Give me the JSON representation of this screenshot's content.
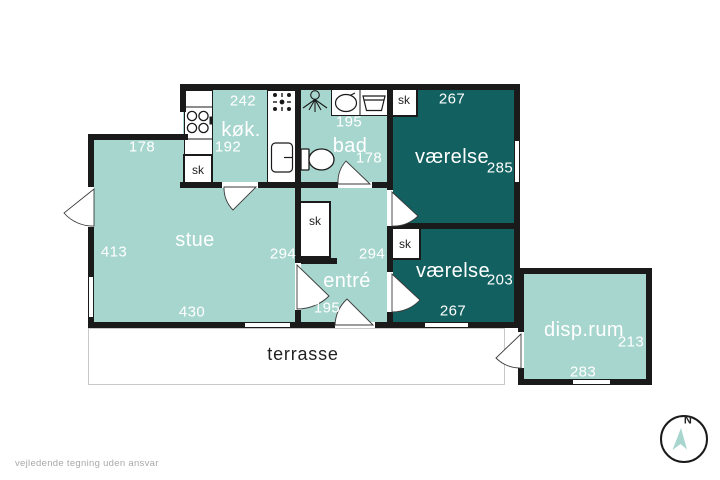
{
  "meta": {
    "disclaimer": "vejledende tegning uden ansvar",
    "compass_north": "N"
  },
  "colors": {
    "room_light": "#a7d6ce",
    "room_dark": "#136060",
    "wall": "#1a1a1a",
    "terrace_border": "#c9c9c9",
    "text_light": "#ffffff",
    "text_dark": "#222222",
    "muted": "#a8a8a8",
    "compass_arrow": "#a8d5ce"
  },
  "plan": {
    "closet_label": "sk",
    "rooms": {
      "stue": {
        "name": "stue",
        "m_top": "178",
        "m_left": "413",
        "m_right": "294",
        "m_bottom": "430"
      },
      "koekken": {
        "name": "køk.",
        "m_top": "242",
        "m_bottom": "192"
      },
      "bad": {
        "name": "bad",
        "m_top": "195",
        "m_right": "178"
      },
      "vaerelse1": {
        "name": "værelse",
        "m_top": "267",
        "m_right": "285"
      },
      "vaerelse2": {
        "name": "værelse",
        "m_right": "203",
        "m_bottom": "267"
      },
      "entre": {
        "name": "entré",
        "m_right": "294",
        "m_bottom": "195"
      },
      "disprum": {
        "name": "disp.rum",
        "m_right": "213",
        "m_bottom": "283"
      },
      "terrasse": {
        "name": "terrasse"
      }
    },
    "icons": [
      "stove-icon",
      "cooker-hood-icon",
      "kitchen-sink-icon",
      "shower-icon",
      "washbasin-icon",
      "washing-machine-icon",
      "toilet-icon",
      "door-arc-icon",
      "compass-icon"
    ]
  }
}
